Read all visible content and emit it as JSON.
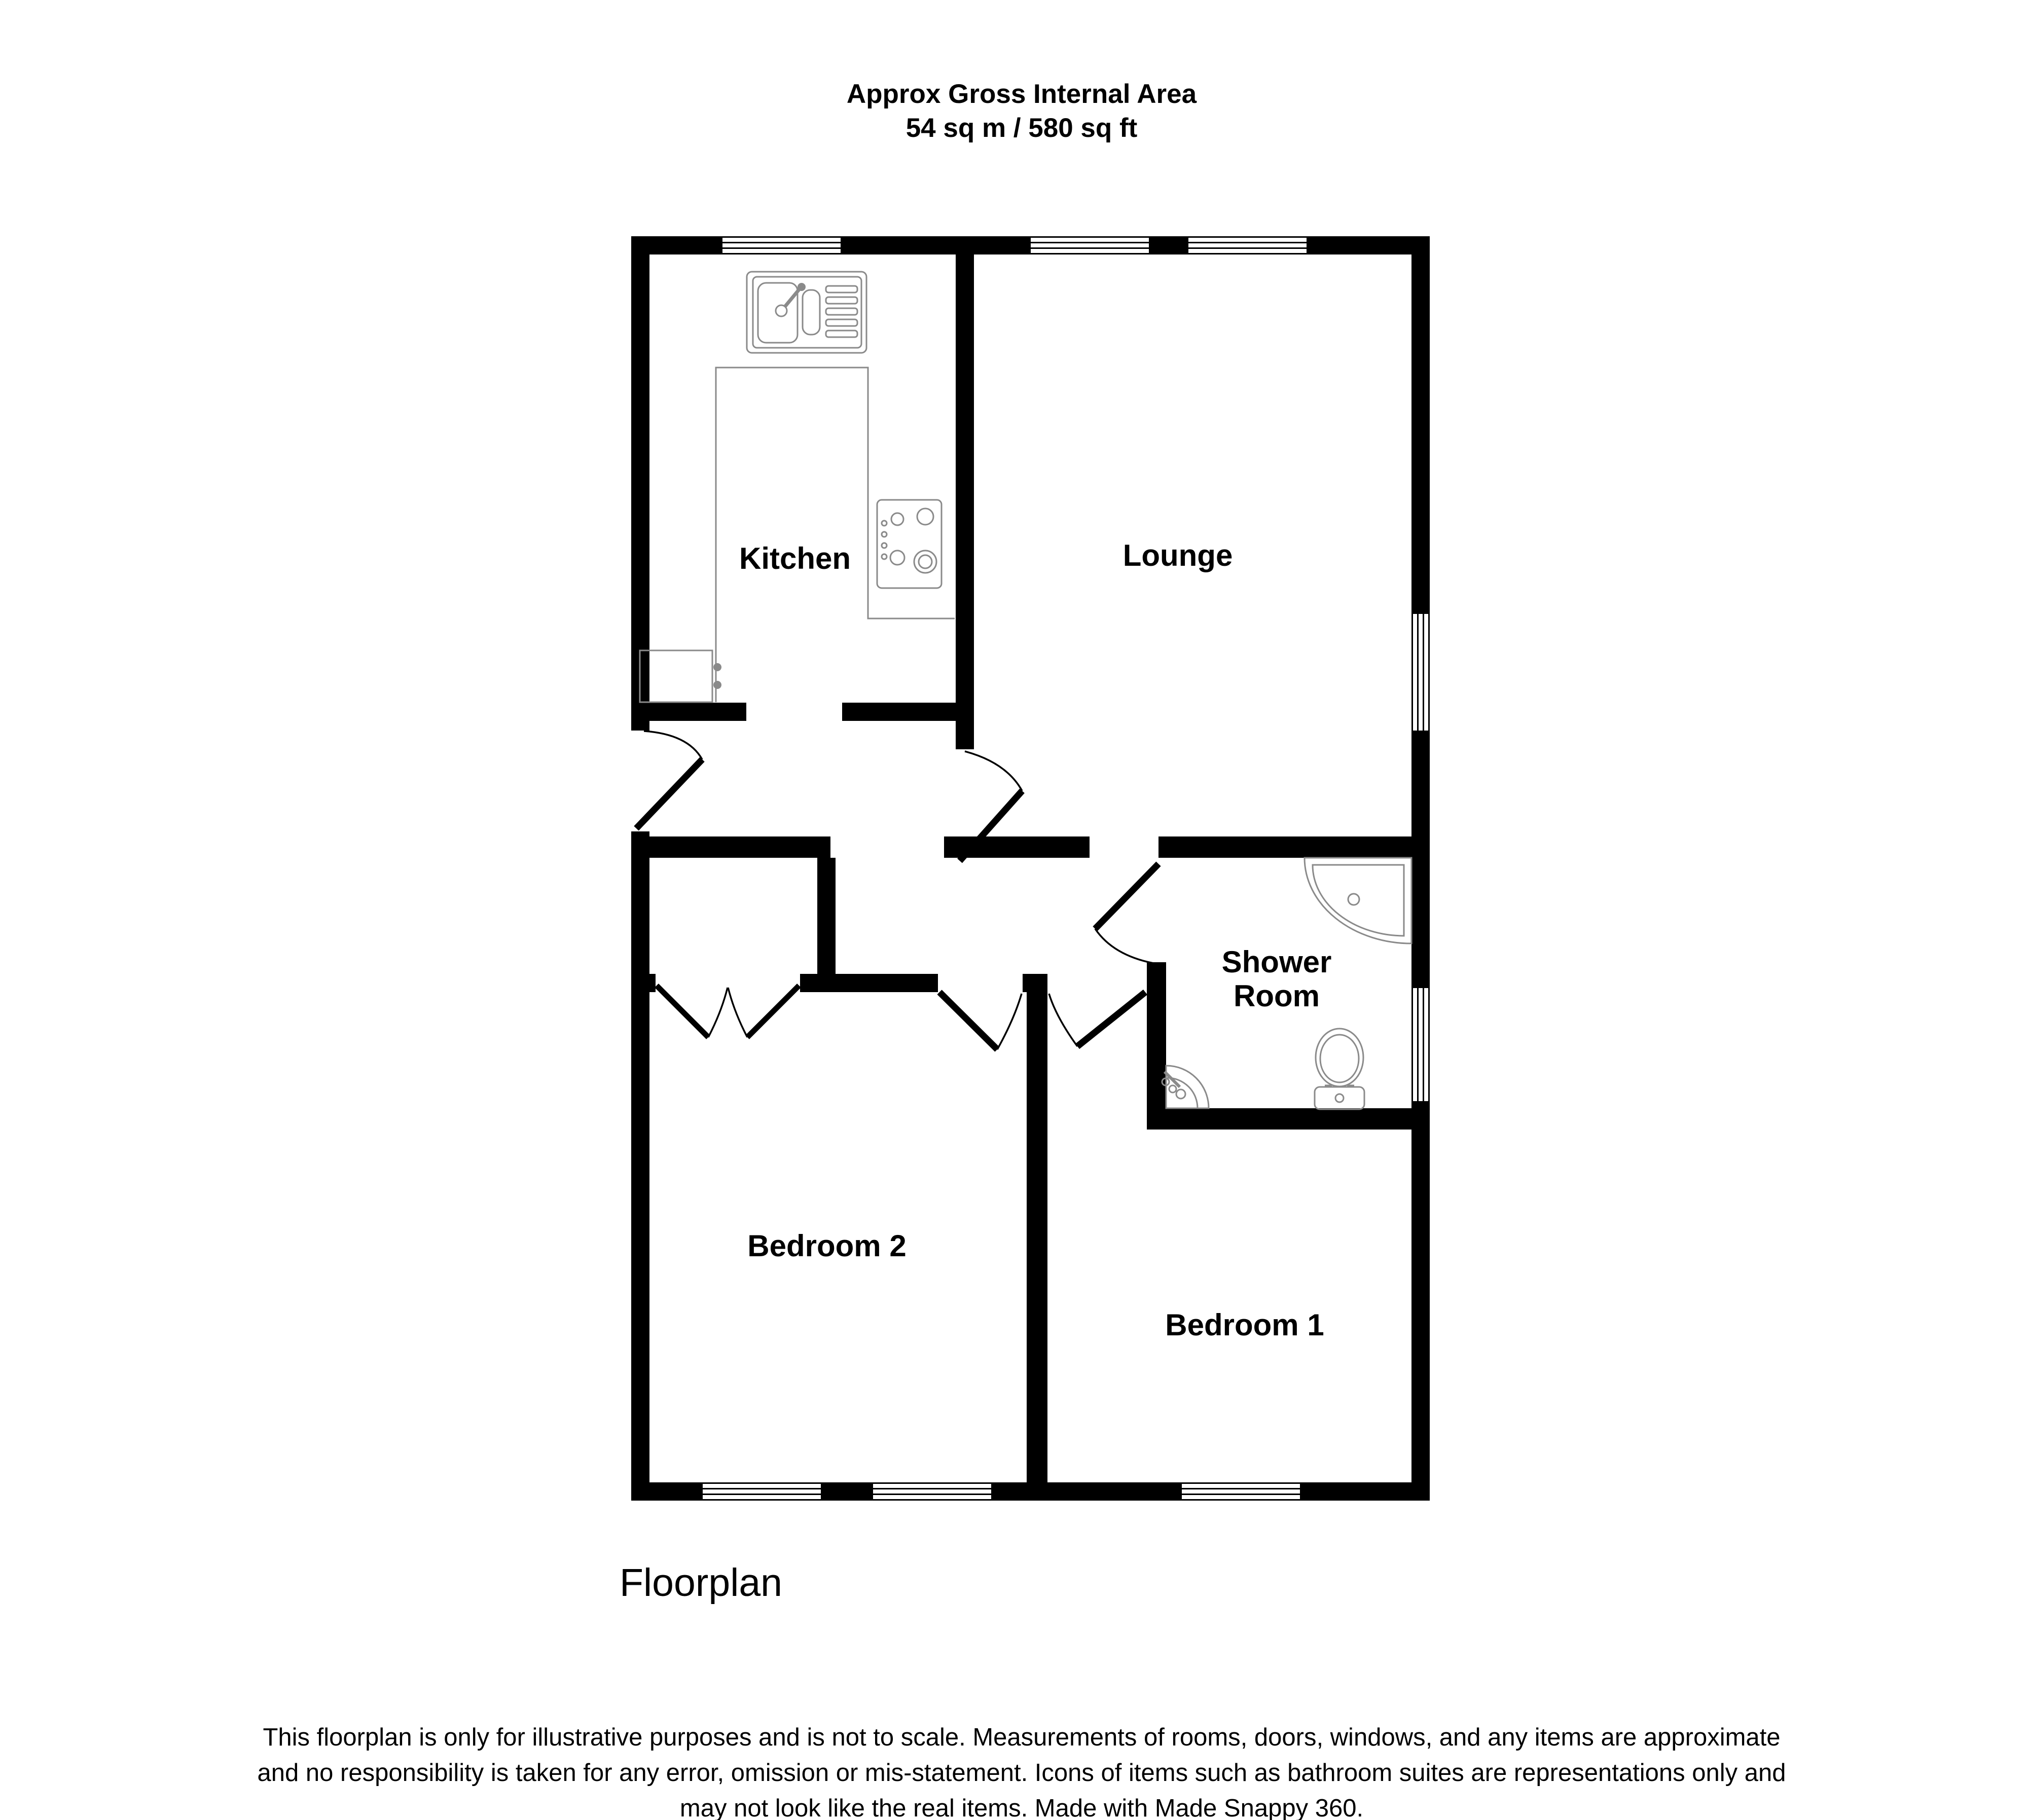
{
  "title": {
    "line1": "Approx Gross Internal Area",
    "line2": "54 sq m / 580 sq ft"
  },
  "rooms": {
    "kitchen": {
      "label": "Kitchen"
    },
    "lounge": {
      "label": "Lounge"
    },
    "shower_room": {
      "line1": "Shower",
      "line2": "Room"
    },
    "bedroom2": {
      "label": "Bedroom 2"
    },
    "bedroom1": {
      "label": "Bedroom 1"
    }
  },
  "caption": "Floorplan",
  "disclaimer": {
    "line1": "This floorplan is only for illustrative purposes and is not to scale. Measurements of rooms, doors, windows, and any items are approximate",
    "line2": "and no responsibility is taken for any error, omission or mis-statement. Icons of items such as bathroom suites are representations only and",
    "line3": "may not look like the real items. Made with Made Snappy 360."
  },
  "fixtures": {
    "sink": "kitchen sink with drainer",
    "hob": "4-ring hob",
    "boiler": "kitchen unit",
    "counter": "worktop",
    "shower": "corner shower tray",
    "toilet": "toilet",
    "basin": "corner basin"
  },
  "colors": {
    "wall": "#000000",
    "fixture_outline": "#8a8a8a",
    "text": "#000000",
    "background": "#ffffff"
  }
}
